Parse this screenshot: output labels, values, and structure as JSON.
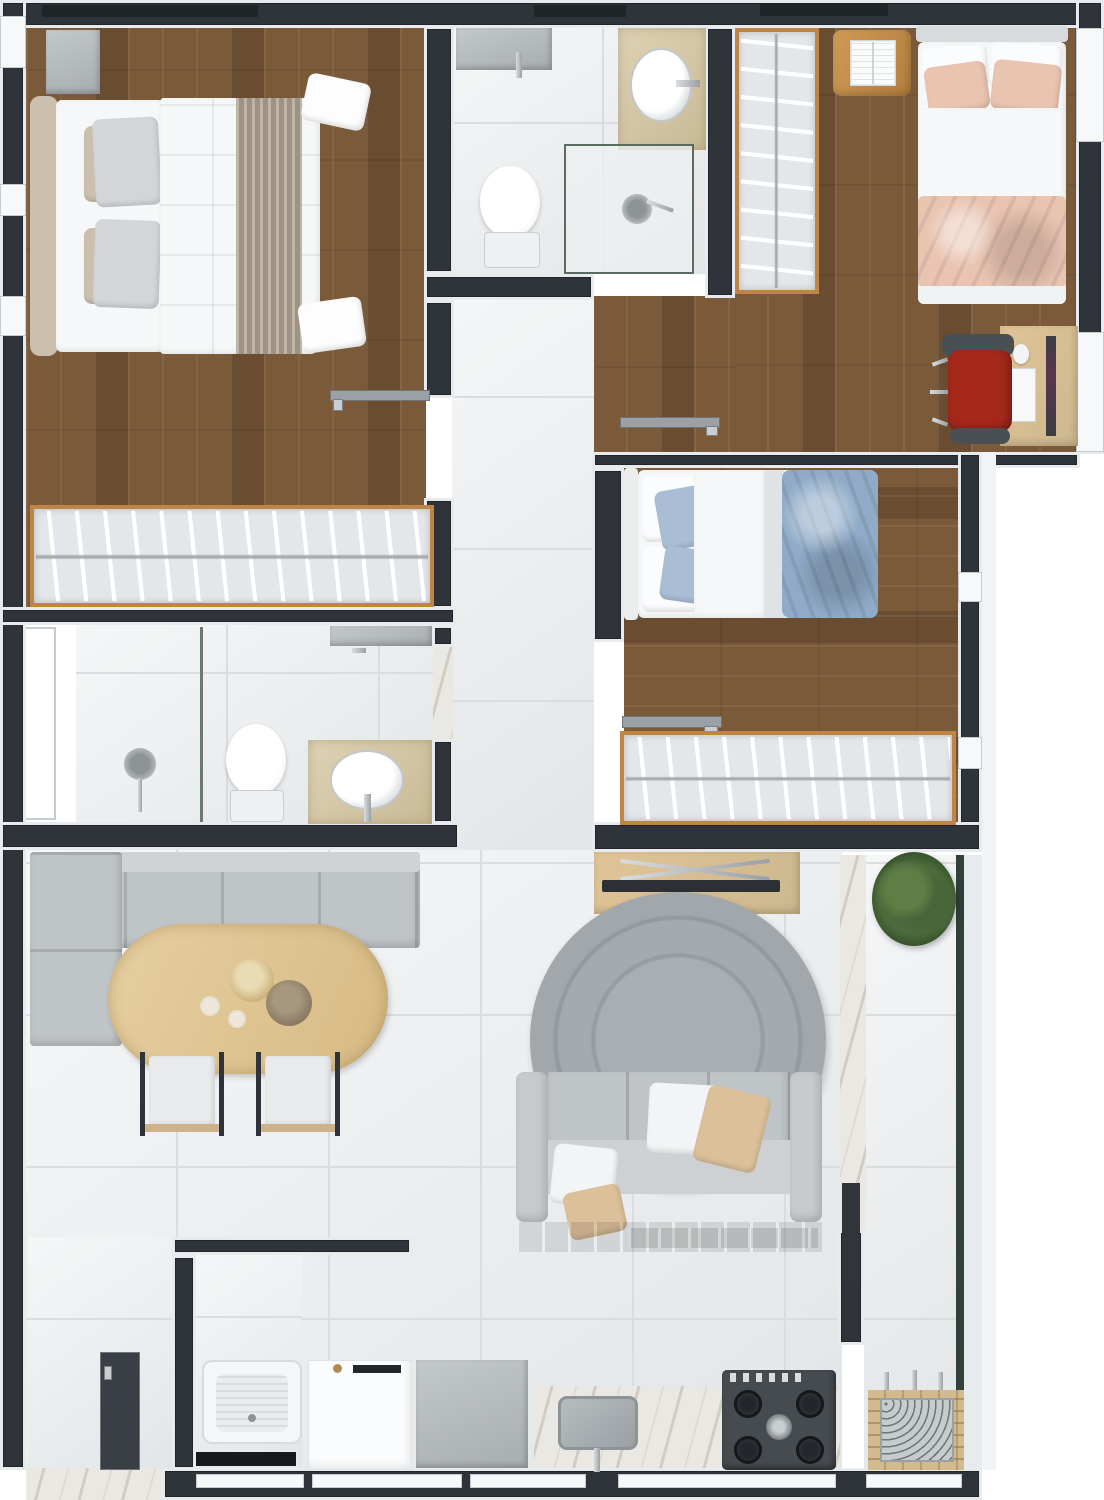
{
  "scene": {
    "kind": "apartment-floor-plan-render",
    "view": "top-down",
    "canvas": {
      "width_px": 1104,
      "height_px": 1500
    }
  },
  "palette": {
    "background": "#ffffff",
    "wall": "#2f343a",
    "wall_dark": "#1f2327",
    "trim": "#e8ebee",
    "trim_shadow": "#c6cbcf",
    "wood_floor": "#7b5a39",
    "wood_trim": "#c08445",
    "wood_light": "#dfc497",
    "wood_mid": "#caa86c",
    "tile": "#eaedef",
    "tile_grout": "#d9dde0",
    "marble": "#eae8e3",
    "white_soft": "#f5f7f8",
    "gray_soft": "#c9cdd0",
    "gray_mid": "#aeb3b6",
    "sofa_gray": "#bfc4c7",
    "rug_gray": "#a0a6aa",
    "peach": "#e9c4b1",
    "blue_soft": "#a9bed4",
    "blue_mid": "#8fabc8",
    "beige": "#cbbfae",
    "tan_pillow": "#dcc09a",
    "taupe_runner": "#a99b8b",
    "red_chair": "#a5281b",
    "plant_green": "#4c6b3c",
    "glass_green": "#31413a",
    "stove_dark": "#464b50",
    "brick": "#d3b98e"
  },
  "rooms": [
    {
      "name": "master bedroom",
      "floor": "wood",
      "contents": [
        "double bed with taupe runner",
        "headboard cushions",
        "gray nightstand",
        "open wardrobe with hangers",
        "swing door"
      ]
    },
    {
      "name": "ensuite bathroom",
      "floor": "tile",
      "contents": [
        "wall shelf with faucet",
        "oval countertop sink",
        "toilet",
        "glass shower enclosure with drain"
      ]
    },
    {
      "name": "bedroom 2",
      "floor": "wood",
      "contents": [
        "single bed with peach bedding",
        "open wardrobe with hangers",
        "nightstand with open book",
        "desk with monitor keyboard mouse",
        "red office chair"
      ]
    },
    {
      "name": "bedroom 3",
      "floor": "wood",
      "contents": [
        "single bed with blue bedding",
        "open wardrobe with hangers",
        "swing door"
      ]
    },
    {
      "name": "bathroom 2",
      "floor": "tile",
      "contents": [
        "shower head and drain",
        "glass partition",
        "toilet",
        "oval countertop sink",
        "wall shelf",
        "marble threshold"
      ]
    },
    {
      "name": "hallway",
      "floor": "tile",
      "contents": []
    },
    {
      "name": "living dining room",
      "floor": "tile",
      "contents": [
        "L-shaped corner bench sofa",
        "oval wooden dining table",
        "two serving bowls",
        "two candles",
        "two dining chairs",
        "TV console with television",
        "round gray rug",
        "three-seat sofa with cushions on wood base"
      ]
    },
    {
      "name": "kitchen",
      "floor": "tile",
      "contents": [
        "laundry tub",
        "washing machine",
        "gray appliance unit",
        "marble counter with sink and faucet",
        "gas cooktop with four burners",
        "wood upper shelf"
      ]
    },
    {
      "name": "service entry",
      "floor": "tile",
      "contents": [
        "open service door",
        "marble threshold"
      ]
    },
    {
      "name": "balcony",
      "floor": "tile",
      "contents": [
        "potted plant",
        "marble transition strip",
        "glass balustrade",
        "brick barbecue grill with tools"
      ]
    },
    {
      "name": "air shaft",
      "floor": "none",
      "contents": []
    }
  ]
}
